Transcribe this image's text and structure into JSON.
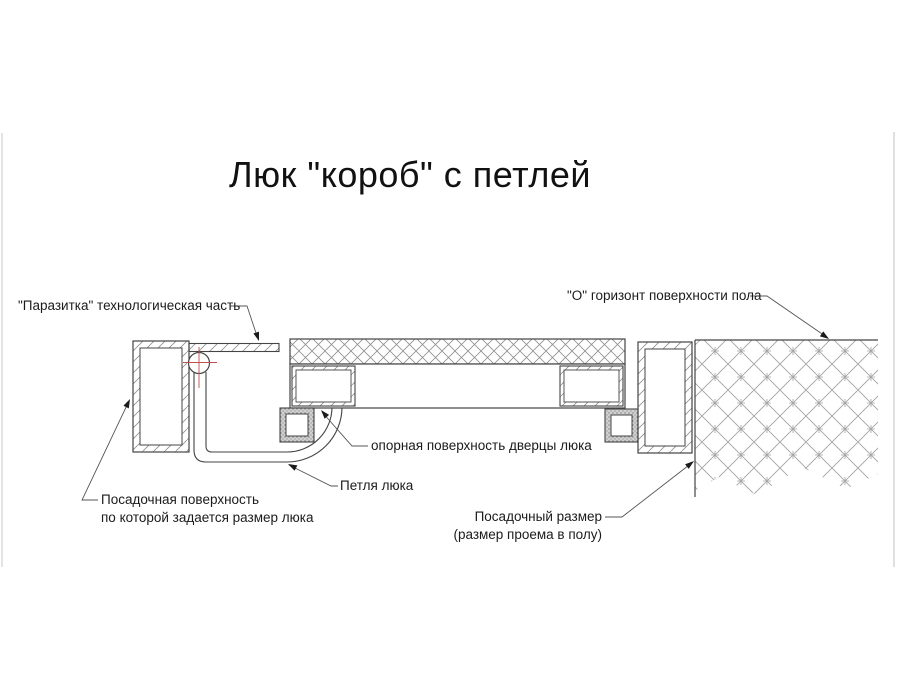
{
  "title": "Люк \"короб\" с петлей",
  "labels": {
    "parasitka": "\"Паразитка\" технологическая часть",
    "floor_horizon": "\"О\" горизонт поверхности пола",
    "door_support_surface": "опорная поверхность дверцы люка",
    "hinge": "Петля люка",
    "seating_surface": {
      "line1": "Посадочная поверхность",
      "line2": "по которой задается размер люка"
    },
    "seating_size": {
      "line1": "Посадочный размер",
      "line2": "(размер проема в полу)"
    }
  },
  "colors": {
    "line": "#444444",
    "leader": "#555555",
    "center_mark_red": "#c0504d",
    "hatch": "#8f8f8f",
    "floor_hatch": "#a3a3a3",
    "bracket_fill": "#d0d0d0",
    "text": "#1b1b1b",
    "background": "#ffffff"
  }
}
